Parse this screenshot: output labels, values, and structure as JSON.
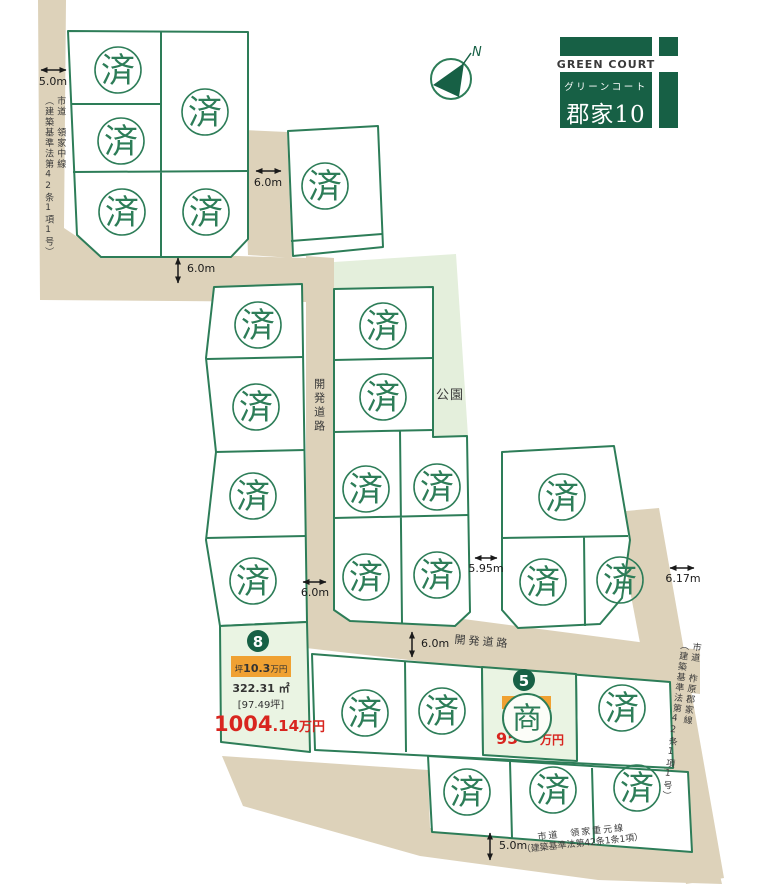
{
  "logo": {
    "name_en": "GREEN COURT",
    "name_kana": "グリーンコート",
    "name_jp": "郡家10"
  },
  "compass": {
    "north_label": "N"
  },
  "park": {
    "label": "公園"
  },
  "roads": {
    "left": {
      "name": "市道　領家中線",
      "law": "（建築基準法第42条1項1号）"
    },
    "right": {
      "name": "市道　柞原郡家線",
      "law": "（建築基準法第42条1項1号）"
    },
    "bottom": {
      "name": "市道　領家重元線",
      "law": "（建築基準法第42条1条1項）"
    },
    "dev_road_v": "開発道路",
    "dev_road_h": "開発道路"
  },
  "dimensions": {
    "d1": "5.0m",
    "d2": "6.0m",
    "d3": "6.0m",
    "d4": "6.0m",
    "d5": "5.95m",
    "d6": "6.17m",
    "d7": "6.0m",
    "d8": "5.0m"
  },
  "stamps": {
    "sold": "済",
    "negotiating": "商",
    "sold_positions": [
      [
        118,
        70
      ],
      [
        205,
        112
      ],
      [
        121,
        141
      ],
      [
        122,
        212
      ],
      [
        206,
        212
      ],
      [
        325,
        186
      ],
      [
        258,
        325
      ],
      [
        256,
        407
      ],
      [
        253,
        496
      ],
      [
        253,
        581
      ],
      [
        383,
        326
      ],
      [
        383,
        397
      ],
      [
        366,
        489
      ],
      [
        437,
        487
      ],
      [
        366,
        577
      ],
      [
        437,
        575
      ],
      [
        562,
        497
      ],
      [
        543,
        582
      ],
      [
        620,
        580
      ],
      [
        365,
        713
      ],
      [
        442,
        711
      ],
      [
        622,
        708
      ],
      [
        467,
        792
      ],
      [
        553,
        790
      ],
      [
        637,
        788
      ]
    ]
  },
  "plot8": {
    "number": "8",
    "unit_price": {
      "prefix": "坪",
      "value": "10.3",
      "suffix": "万円"
    },
    "area_m2": "322.31 ㎡",
    "area_tsubo": "[97.49坪]",
    "price": {
      "main": "1004",
      "decimal": ".14",
      "unit": "万円"
    }
  },
  "plot5": {
    "number": "5",
    "price_left": "95",
    "price_right": "万円"
  },
  "colors": {
    "line_green": "#2d7d58",
    "logo_green": "#176045",
    "road_beige": "#ddd2ba",
    "park_green": "#e4efdc",
    "highlight_green": "#eaf4e3",
    "price_red": "#d8251f",
    "highlight_orange": "#f0a132"
  }
}
